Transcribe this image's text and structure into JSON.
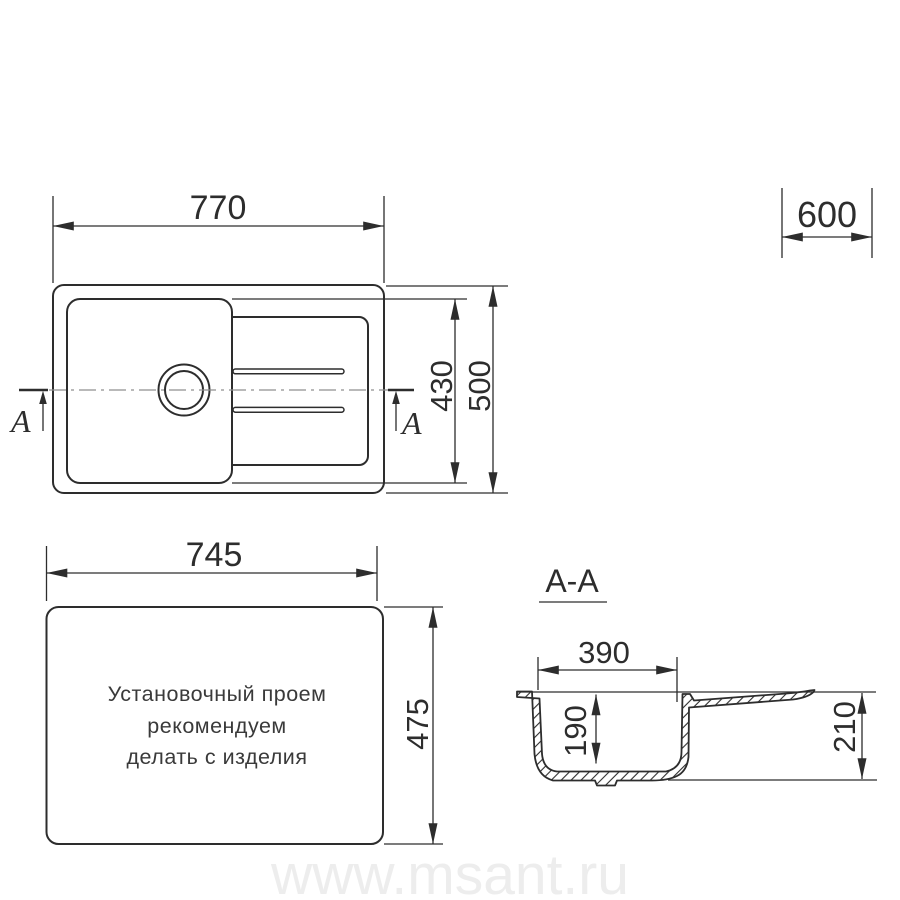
{
  "labels": {
    "top_width": "770",
    "cabinet_width": "600",
    "bowl_height": "430",
    "overall_width_depth": "500",
    "cutout_width": "745",
    "cutout_height": "475",
    "section_title": "A-A",
    "section_bowl_width": "390",
    "section_bowl_depth": "190",
    "section_overall_depth": "210",
    "section_letter_left": "A",
    "section_letter_right": "A"
  },
  "note": {
    "line1": "Установочный проем",
    "line2": "рекомендуем",
    "line3": "делать с изделия"
  },
  "watermark": "www.msant.ru",
  "colors": {
    "line": "#2d2d2d",
    "centerline": "#8f8f8f",
    "note_text": "#3a3a3a",
    "watermark": "#ededed",
    "background": "#ffffff"
  }
}
